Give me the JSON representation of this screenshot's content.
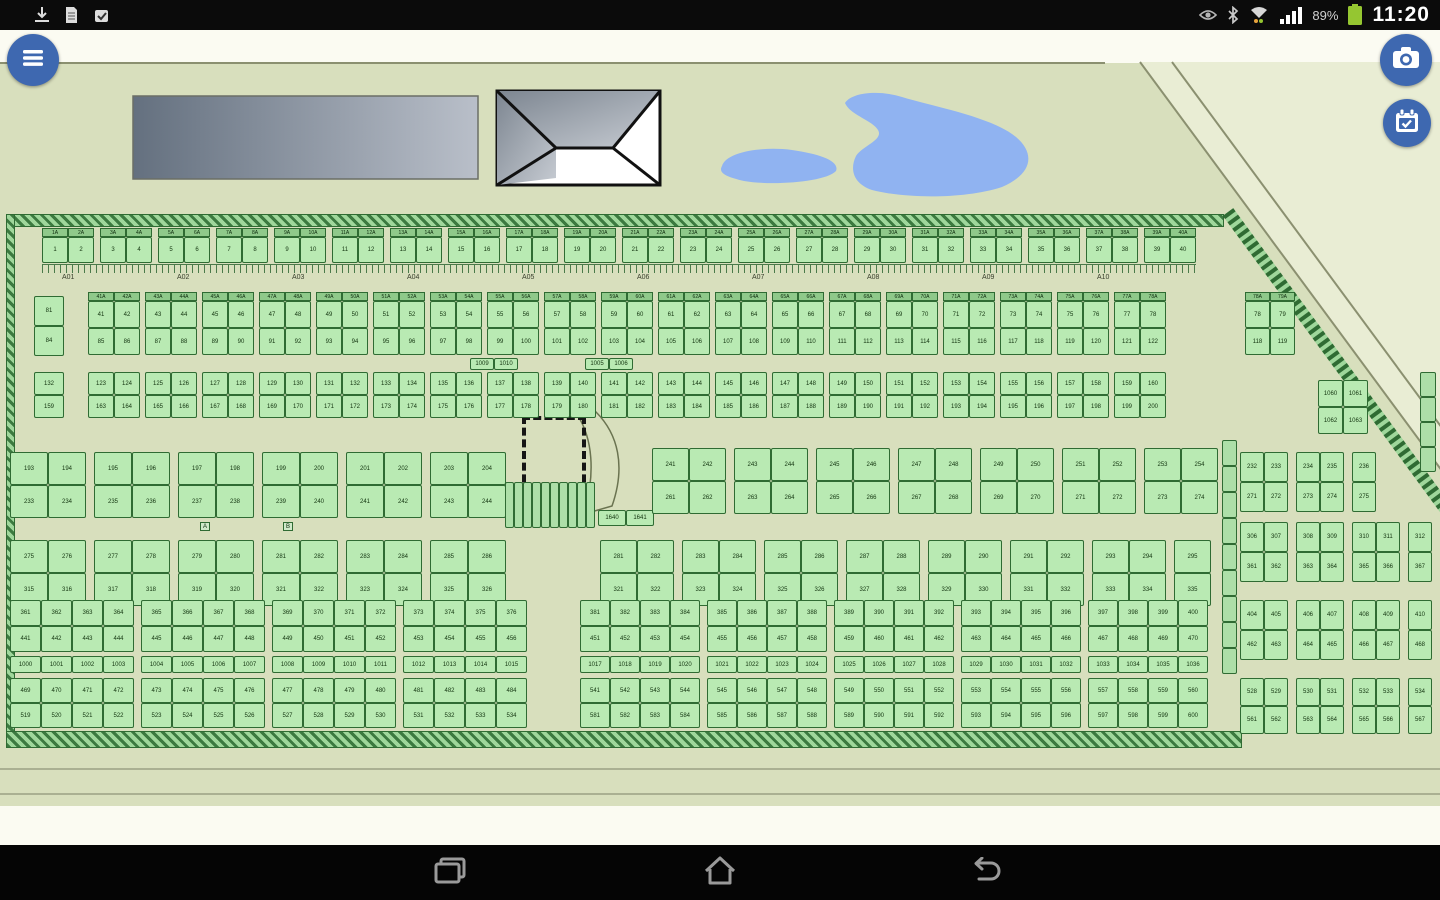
{
  "status_bar": {
    "time": "11:20",
    "battery_percent": "89%",
    "left_icons": [
      "download-icon",
      "document-icon",
      "check-badge-icon"
    ],
    "right_icons": [
      "smart-stay-eye-icon",
      "bluetooth-icon",
      "wifi-tether-icon",
      "signal-icon",
      "battery-icon"
    ]
  },
  "toolbar": {
    "menu_button": "menu",
    "camera_button": "camera",
    "schedule_button": "schedule"
  },
  "nav_bar": {
    "buttons": [
      "recent-apps",
      "home",
      "back"
    ]
  },
  "map": {
    "colors": {
      "background": "#d8dfbd",
      "outside": "#e9edd4",
      "plot_fill": "#b9eab3",
      "plot_border": "#2f6b33",
      "pond": "#90b3f1",
      "road_line": "#8b9070",
      "building_dark": "#64707f",
      "building_light": "#b9bfc9",
      "button_blue": "#3e68b0",
      "battery_green": "#95c631"
    },
    "features": [
      "office-building",
      "pavilion-roof-building",
      "pond",
      "court-foundation",
      "boundary-hatch",
      "perimeter-roads"
    ],
    "road_labels_top": [
      "A01",
      "A02",
      "A03",
      "A04",
      "A05",
      "A06",
      "A07",
      "A08",
      "A09",
      "A10"
    ],
    "row_markers": [
      {
        "x": 200,
        "y": 522,
        "label": "A"
      },
      {
        "x": 283,
        "y": 522,
        "label": "B"
      }
    ],
    "blocks": [
      {
        "x": 42,
        "y": 228,
        "cols": 40,
        "rows": 1,
        "cw": 26,
        "ch": 26,
        "gE": 2,
        "gS": 6,
        "hdr": true,
        "starts": [
          1
        ]
      },
      {
        "x": 34,
        "y": 296,
        "cols": 1,
        "rows": 2,
        "cw": 30,
        "ch": 30,
        "gE": 0,
        "gS": 0,
        "hdr": false,
        "starts": [
          81,
          84
        ]
      },
      {
        "x": 88,
        "y": 292,
        "cols": 38,
        "rows": 2,
        "cw": 26,
        "ch": 27,
        "gE": 2,
        "gS": 5,
        "hdr": true,
        "starts": [
          41,
          85
        ]
      },
      {
        "x": 470,
        "y": 358,
        "cols": 2,
        "rows": 1,
        "cw": 24,
        "ch": 12,
        "gE": 0,
        "gS": 0,
        "hdr": false,
        "starts": [
          1009
        ]
      },
      {
        "x": 585,
        "y": 358,
        "cols": 2,
        "rows": 1,
        "cw": 24,
        "ch": 12,
        "gE": 0,
        "gS": 0,
        "hdr": false,
        "starts": [
          1005
        ]
      },
      {
        "x": 34,
        "y": 372,
        "cols": 1,
        "rows": 2,
        "cw": 30,
        "ch": 23,
        "gE": 0,
        "gS": 0,
        "hdr": false,
        "starts": [
          132,
          159
        ]
      },
      {
        "x": 88,
        "y": 372,
        "cols": 38,
        "rows": 2,
        "cw": 26,
        "ch": 23,
        "gE": 2,
        "gS": 5,
        "hdr": false,
        "starts": [
          123,
          163
        ]
      },
      {
        "x": 505,
        "y": 482,
        "cols": 10,
        "rows": 1,
        "cw": 9,
        "ch": 46,
        "gE": 0,
        "gS": 0,
        "hdr": false,
        "starts": null
      },
      {
        "x": 598,
        "y": 510,
        "cols": 2,
        "rows": 1,
        "cw": 28,
        "ch": 16,
        "gE": 0,
        "gS": 0,
        "hdr": false,
        "starts": [
          1640
        ]
      },
      {
        "x": 10,
        "y": 452,
        "cols": 12,
        "rows": 2,
        "cw": 38,
        "ch": 33,
        "gE": 2,
        "gS": 8,
        "hdr": false,
        "starts": [
          193,
          233
        ]
      },
      {
        "x": 652,
        "y": 448,
        "cols": 14,
        "rows": 2,
        "cw": 37,
        "ch": 33,
        "gE": 2,
        "gS": 8,
        "hdr": false,
        "starts": [
          241,
          261
        ]
      },
      {
        "x": 10,
        "y": 540,
        "cols": 12,
        "rows": 2,
        "cw": 38,
        "ch": 33,
        "gE": 2,
        "gS": 8,
        "hdr": false,
        "starts": [
          275,
          315
        ]
      },
      {
        "x": 600,
        "y": 540,
        "cols": 15,
        "rows": 2,
        "cw": 37,
        "ch": 33,
        "gE": 2,
        "gS": 8,
        "hdr": false,
        "starts": [
          281,
          321
        ]
      },
      {
        "x": 10,
        "y": 600,
        "cols": 16,
        "rows": 2,
        "cw": 31,
        "ch": 26,
        "gE": 4,
        "gS": 7,
        "hdr": false,
        "starts": [
          361,
          441
        ]
      },
      {
        "x": 10,
        "y": 656,
        "cols": 16,
        "rows": 1,
        "cw": 31,
        "ch": 17,
        "gE": 4,
        "gS": 7,
        "hdr": false,
        "starts": [
          1000
        ]
      },
      {
        "x": 10,
        "y": 678,
        "cols": 16,
        "rows": 2,
        "cw": 31,
        "ch": 25,
        "gE": 4,
        "gS": 7,
        "hdr": false,
        "starts": [
          469,
          519
        ]
      },
      {
        "x": 580,
        "y": 600,
        "cols": 20,
        "rows": 2,
        "cw": 30,
        "ch": 26,
        "gE": 4,
        "gS": 7,
        "hdr": false,
        "starts": [
          381,
          451
        ]
      },
      {
        "x": 580,
        "y": 656,
        "cols": 20,
        "rows": 1,
        "cw": 30,
        "ch": 17,
        "gE": 4,
        "gS": 7,
        "hdr": false,
        "starts": [
          1017
        ]
      },
      {
        "x": 580,
        "y": 678,
        "cols": 20,
        "rows": 2,
        "cw": 30,
        "ch": 25,
        "gE": 4,
        "gS": 7,
        "hdr": false,
        "starts": [
          541,
          581
        ]
      },
      {
        "x": 1245,
        "y": 292,
        "cols": 2,
        "rows": 2,
        "cw": 25,
        "ch": 27,
        "gE": 0,
        "gS": 0,
        "hdr": true,
        "starts": [
          78,
          118
        ]
      },
      {
        "x": 1318,
        "y": 380,
        "cols": 2,
        "rows": 2,
        "cw": 25,
        "ch": 27,
        "gE": 0,
        "gS": 0,
        "hdr": false,
        "starts": [
          1060,
          1062
        ]
      },
      {
        "x": 1240,
        "y": 452,
        "cols": 5,
        "rows": 2,
        "cw": 24,
        "ch": 30,
        "gE": 2,
        "gS": 8,
        "hdr": false,
        "starts": [
          232,
          271
        ]
      },
      {
        "x": 1240,
        "y": 522,
        "cols": 7,
        "rows": 2,
        "cw": 24,
        "ch": 30,
        "gE": 2,
        "gS": 8,
        "hdr": false,
        "starts": [
          306,
          361
        ]
      },
      {
        "x": 1240,
        "y": 600,
        "cols": 7,
        "rows": 2,
        "cw": 24,
        "ch": 30,
        "gE": 2,
        "gS": 8,
        "hdr": false,
        "starts": [
          404,
          462
        ]
      },
      {
        "x": 1240,
        "y": 678,
        "cols": 7,
        "rows": 2,
        "cw": 24,
        "ch": 28,
        "gE": 2,
        "gS": 8,
        "hdr": false,
        "starts": [
          528,
          561
        ]
      },
      {
        "x": 1222,
        "y": 440,
        "cols": 1,
        "rows": 9,
        "cw": 15,
        "ch": 26,
        "gE": 0,
        "gS": 0,
        "hdr": false,
        "starts": null
      },
      {
        "x": 1420,
        "y": 372,
        "cols": 1,
        "rows": 4,
        "cw": 16,
        "ch": 25,
        "gE": 0,
        "gS": 0,
        "hdr": false,
        "starts": null
      }
    ]
  }
}
